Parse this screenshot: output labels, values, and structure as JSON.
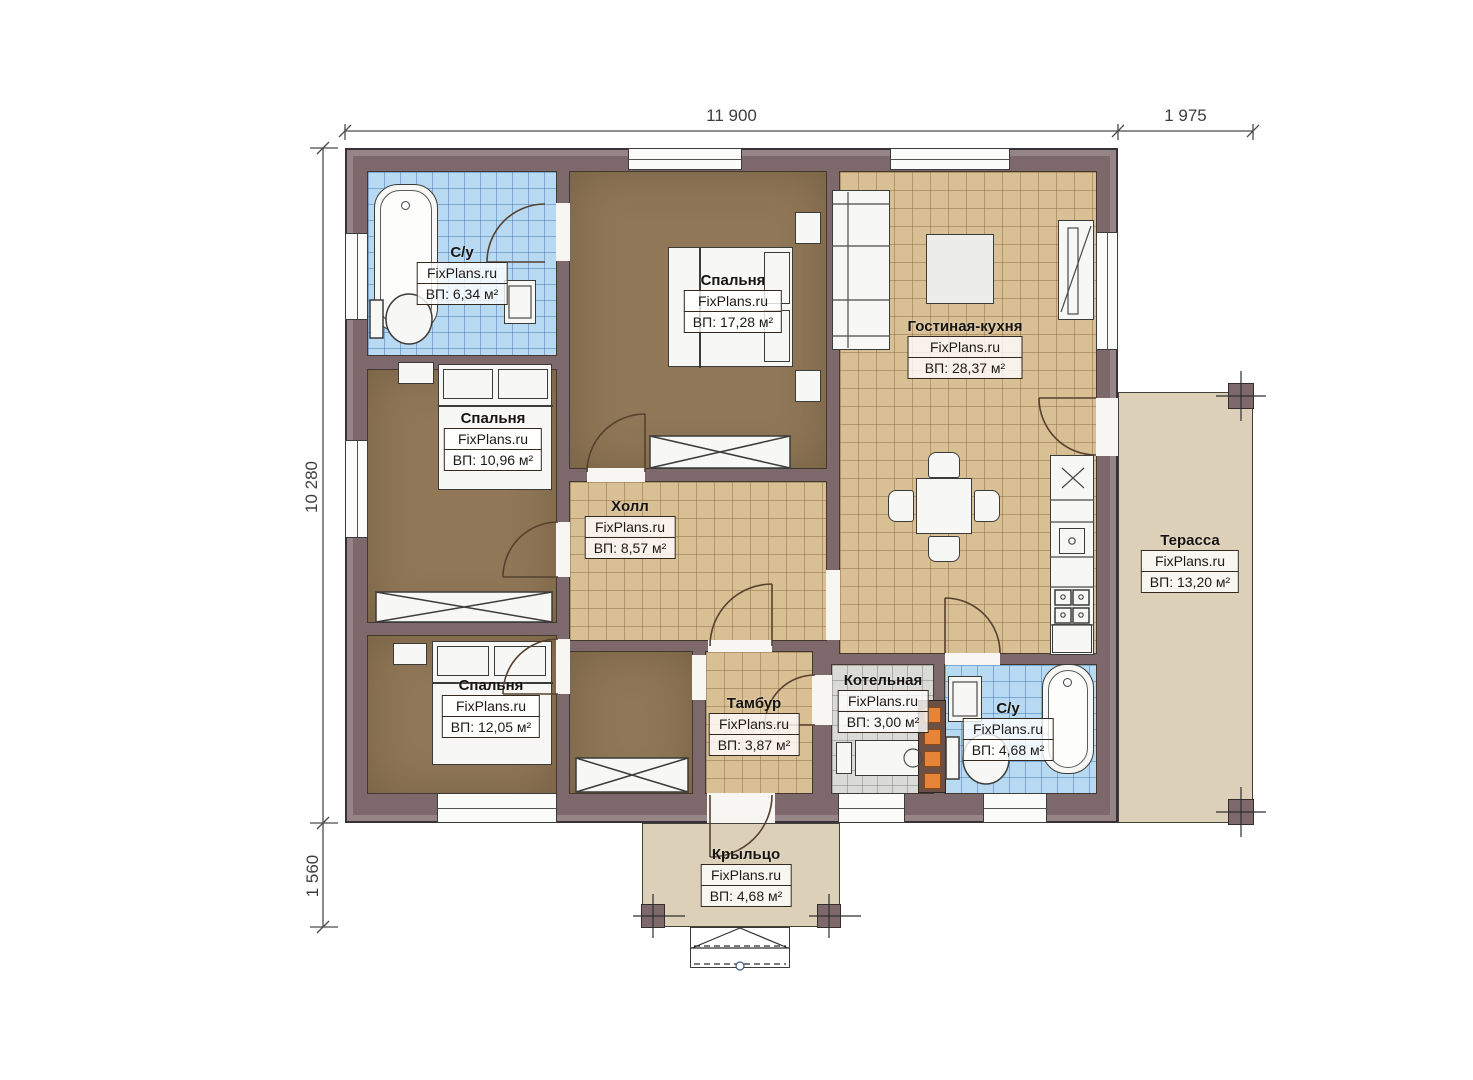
{
  "watermark": "FixPlans.ru",
  "dimensions": {
    "width_main": "11 900",
    "width_terrace": "1 975",
    "height_main": "10 280",
    "height_porch": "1 560"
  },
  "rooms": [
    {
      "id": "bathroom-1",
      "name": "С/у",
      "area": "ВП: 6,34 м²"
    },
    {
      "id": "bedroom-1",
      "name": "Спальня",
      "area": "ВП: 17,28 м²"
    },
    {
      "id": "living-kitchen",
      "name": "Гостиная-кухня",
      "area": "ВП: 28,37 м²"
    },
    {
      "id": "bedroom-2",
      "name": "Спальня",
      "area": "ВП: 10,96 м²"
    },
    {
      "id": "hall",
      "name": "Холл",
      "area": "ВП: 8,57 м²"
    },
    {
      "id": "bedroom-3",
      "name": "Спальня",
      "area": "ВП: 12,05 м²"
    },
    {
      "id": "vestibule",
      "name": "Тамбур",
      "area": "ВП: 3,87 м²"
    },
    {
      "id": "boiler-room",
      "name": "Котельная",
      "area": "ВП: 3,00 м²"
    },
    {
      "id": "bathroom-2",
      "name": "С/у",
      "area": "ВП: 4,68 м²"
    },
    {
      "id": "terrace",
      "name": "Терасса",
      "area": "ВП: 13,20 м²"
    },
    {
      "id": "porch",
      "name": "Крыльцо",
      "area": "ВП: 4,68 м²"
    }
  ],
  "colors": {
    "wall": "#7d696c",
    "floor_wood": "#8f7757",
    "tile_beige": "#d9bf94",
    "tile_blue": "#b7d9f2",
    "tile_gray": "#dadad7",
    "outdoor": "#ddd0b8",
    "chimney_accent": "#e8833a"
  }
}
